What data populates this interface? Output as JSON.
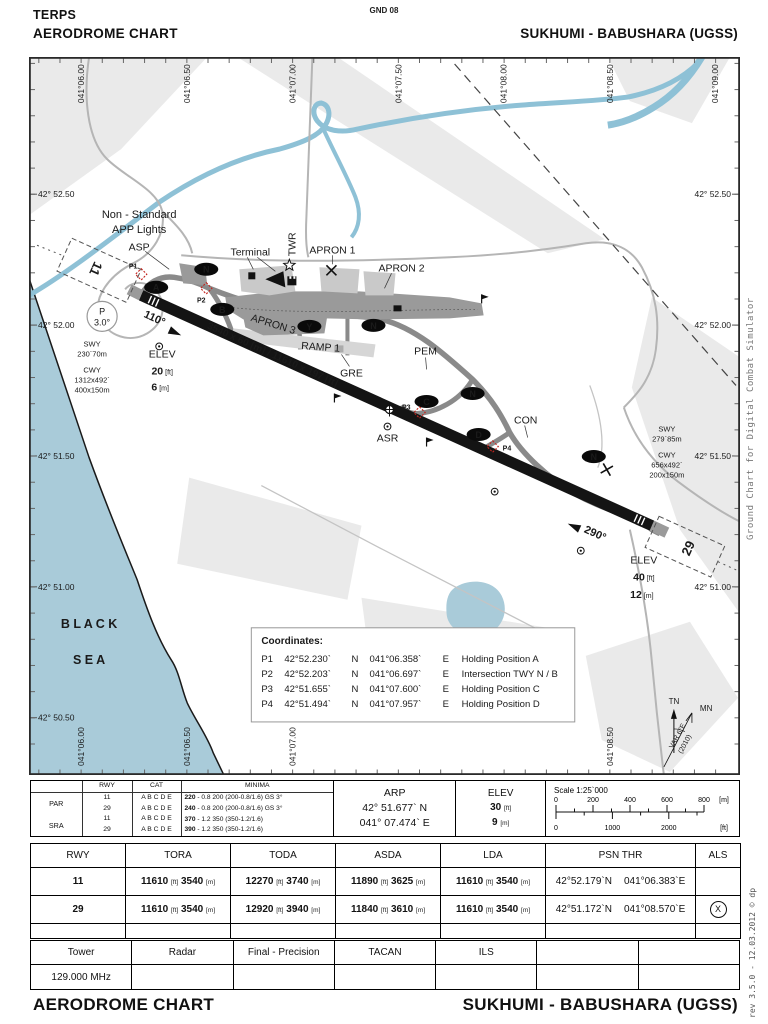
{
  "header": {
    "line1": "TERPS",
    "line2": "AERODROME CHART",
    "top_center": "GND 08",
    "right": "SUKHUMI - BABUSHARA (UGSS)"
  },
  "units": {
    "ft": "[ft]",
    "m": "[m]"
  },
  "map": {
    "top_lon": [
      "041°06.00",
      "041°06.50",
      "041°07.00",
      "041°07.50",
      "041°08.00",
      "041°08.50",
      "041°09.00"
    ],
    "bottom_lon": [
      "041°06.00",
      "041°06.50",
      "041°07.00",
      "041°08.50"
    ],
    "left_lat": [
      "42° 52.50",
      "42° 52.00",
      "42° 51.50",
      "42° 51.00",
      "42° 50.50"
    ],
    "right_lat": [
      "42° 52.50",
      "42° 52.00",
      "42° 51.50",
      "42° 51.00"
    ],
    "sea1": "B L A C K",
    "sea2": "S E A",
    "app_lights1": "Non - Standard",
    "app_lights2": "APP Lights",
    "labels": {
      "asp": "ASP",
      "terminal": "Terminal",
      "twr": "TWR",
      "apron1": "APRON 1",
      "apron2": "APRON 2",
      "apron3": "APRON 3",
      "ramp1": "RAMP 1",
      "gre": "GRE",
      "pem": "PEM",
      "con": "CON",
      "asr": "ASR"
    },
    "rwy11": {
      "num": "11",
      "brg": "110°",
      "elev_label": "ELEV",
      "elev_ft": "20",
      "elev_m": "6",
      "swy": [
        "SWY",
        "230`70m"
      ],
      "cwy": [
        "CWY",
        "1312x492`",
        "400x150m"
      ]
    },
    "rwy29": {
      "num": "29",
      "brg": "290°",
      "elev_label": "ELEV",
      "elev_ft": "40",
      "elev_m": "12",
      "swy": [
        "SWY",
        "279`85m"
      ],
      "cwy": [
        "CWY",
        "656x492`",
        "200x150m"
      ]
    },
    "rwy_dim": "3540 x 60 [m] / 11610 x 197 [ft]",
    "p_circle": {
      "l1": "P",
      "l2": "3.0°"
    },
    "points": {
      "p1": "P1",
      "p2": "P2",
      "p3": "P3",
      "p4": "P4"
    },
    "bubbles": {
      "n": "N",
      "a": "A",
      "b": "B",
      "y": "Y",
      "c": "C",
      "d": "D"
    },
    "compass": {
      "tn": "TN",
      "mn": "MN",
      "var1": "VAR 6°E",
      "var2": "(2010)"
    }
  },
  "coordinates": {
    "title": "Coordinates:",
    "rows": [
      [
        "P1",
        "42°52.230`",
        "N",
        "041°06.358`",
        "E",
        "Holding Position A"
      ],
      [
        "P2",
        "42°52.203`",
        "N",
        "041°06.697`",
        "E",
        "Intersection TWY N / B"
      ],
      [
        "P3",
        "42°51.655`",
        "N",
        "041°07.600`",
        "E",
        "Holding Position C"
      ],
      [
        "P4",
        "42°51.494`",
        "N",
        "041°07.957`",
        "E",
        "Holding Position D"
      ]
    ]
  },
  "minima": {
    "headers": [
      "",
      "RWY",
      "CAT",
      "MINIMA"
    ],
    "groups": [
      "PAR",
      "SRA"
    ],
    "rows": [
      [
        "11",
        "A B C D E",
        "220",
        "- 0.8 200 (200-0.8/1.6) GS 3°"
      ],
      [
        "29",
        "A B C D E",
        "240",
        "- 0.8 200 (200-0.8/1.6) GS 3°"
      ],
      [
        "11",
        "A B C D E",
        "370",
        "- 1.2 350 (350-1.2/1.6)"
      ],
      [
        "29",
        "A B C D E",
        "390",
        "- 1.2 350 (350-1.2/1.6)"
      ]
    ]
  },
  "arp": {
    "label": "ARP",
    "lat": "42° 51.677` N",
    "lon": "041° 07.474` E"
  },
  "elev": {
    "label": "ELEV",
    "ft": "30",
    "m": "9"
  },
  "scale": {
    "title": "Scale 1:25`000",
    "m_ticks": [
      "0",
      "200",
      "400",
      "600",
      "800"
    ],
    "m_unit": "[m]",
    "ft_ticks": [
      "0",
      "1000",
      "2000"
    ],
    "ft_unit": "[ft]"
  },
  "rwy_table": {
    "headers": [
      "RWY",
      "TORA",
      "TODA",
      "ASDA",
      "LDA",
      "PSN THR",
      "ALS"
    ],
    "rows": [
      {
        "rwy": "11",
        "tora_ft": "11610",
        "tora_m": "3540",
        "toda_ft": "12270",
        "toda_m": "3740",
        "asda_ft": "11890",
        "asda_m": "3625",
        "lda_ft": "11610",
        "lda_m": "3540",
        "psn_lat": "42°52.179`N",
        "psn_lon": "041°06.383`E",
        "als": ""
      },
      {
        "rwy": "29",
        "tora_ft": "11610",
        "tora_m": "3540",
        "toda_ft": "12920",
        "toda_m": "3940",
        "asda_ft": "11840",
        "asda_m": "3610",
        "lda_ft": "11610",
        "lda_m": "3540",
        "psn_lat": "42°51.172`N",
        "psn_lon": "041°08.570`E",
        "als": "X"
      }
    ]
  },
  "tower_table": {
    "headers": [
      "Tower",
      "Radar",
      "Final - Precision",
      "TACAN",
      "ILS",
      "",
      ""
    ],
    "values": [
      "129.000 MHz",
      "",
      "",
      "",
      "",
      "",
      ""
    ]
  },
  "footer": {
    "left": "AERODROME CHART",
    "right": "SUKHUMI - BABUSHARA (UGSS)"
  },
  "side_note": "Ground Chart for Digital Combat Simulator",
  "rev_note": "rev 3.5.0  -  12.03.2012 © dp"
}
